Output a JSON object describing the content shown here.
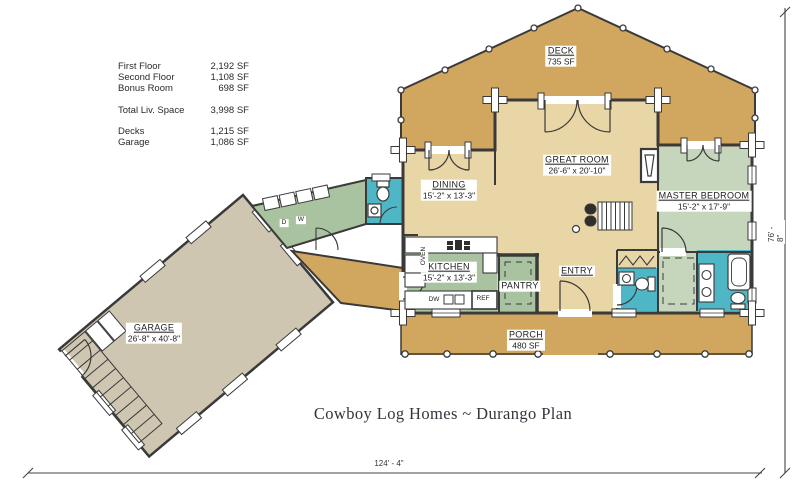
{
  "title": "Cowboy Log Homes ~ Durango Plan",
  "stats": {
    "rows": [
      {
        "label": "First Floor",
        "value": "2,192 SF"
      },
      {
        "label": "Second Floor",
        "value": "1,108 SF"
      },
      {
        "label": "Bonus Room",
        "value": "698 SF"
      },
      {
        "label": "Total Liv. Space",
        "value": "3,998 SF"
      },
      {
        "label": "Decks",
        "value": "1,215 SF"
      },
      {
        "label": "Garage",
        "value": "1,086 SF"
      }
    ]
  },
  "rooms": {
    "deck": {
      "name": "DECK",
      "area": "735 SF"
    },
    "great_room": {
      "name": "GREAT ROOM",
      "dims": "26'-6\" x 20'-10\""
    },
    "dining": {
      "name": "DINING",
      "dims": "15'-2\" x 13'-3\""
    },
    "master_bedroom": {
      "name": "MASTER BEDROOM",
      "dims": "15'-2\" x 17'-9\""
    },
    "kitchen": {
      "name": "KITCHEN",
      "dims": "15'-2\" x 13'-3\""
    },
    "pantry": {
      "name": "PANTRY"
    },
    "entry": {
      "name": "ENTRY"
    },
    "porch": {
      "name": "PORCH",
      "area": "480 SF"
    },
    "garage": {
      "name": "GARAGE",
      "dims": "26'-8\" x 40'-8\""
    }
  },
  "labels": {
    "oven": "OVEN",
    "dishwasher": "DW",
    "refrigerator": "REF",
    "dryer": "D",
    "washer": "W"
  },
  "dimensions": {
    "overall_width": "124' - 4\"",
    "overall_height": "76' - 8\""
  },
  "colors": {
    "deck_porch": "#d1a75f",
    "interior_tan": "#e9d6a7",
    "kitchen_green": "#a9c3a0",
    "bedroom_green": "#c6d6bd",
    "bath_teal": "#4fb6c6",
    "garage_floor": "#cfc6b2",
    "wall": "#3a3a3a"
  }
}
